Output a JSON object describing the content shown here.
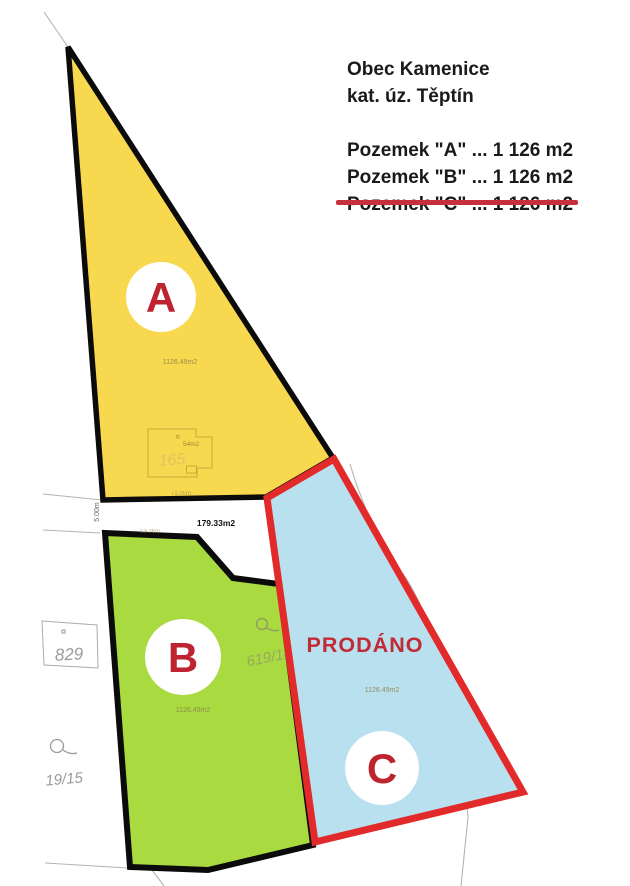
{
  "title": {
    "municipality": "Obec Kamenice",
    "cadastre": "kat. úz. Těptín"
  },
  "legend": {
    "rows": [
      {
        "text": "Pozemek \"A\" ... 1 126 m2",
        "struck": false
      },
      {
        "text": "Pozemek \"B\" ... 1 126 m2",
        "struck": false
      },
      {
        "text": "Pozemek \"C\" ... 1 126 m2",
        "struck": true
      }
    ]
  },
  "parcels": {
    "a": {
      "letter": "A",
      "area": "1126.49m2"
    },
    "b": {
      "letter": "B",
      "area": "1126.49m2"
    },
    "c": {
      "letter": "C",
      "area": "1126.49m2",
      "status": "PRODÁNO"
    }
  },
  "building": {
    "area": "54m2",
    "number": "165"
  },
  "dimensions": {
    "a_bottom_edge": "71.00m",
    "strip_width": "5.00m",
    "strip_area": "179.33m2",
    "b_top_edge": "13.36m"
  },
  "neighbor_plots": {
    "plot_829": "829",
    "plot_19_15": "19/15",
    "plot_619_14": "619/14"
  },
  "colors": {
    "parcel_a_fill": "#f8d84e",
    "parcel_b_fill": "#a9da3f",
    "parcel_c_fill": "#b8e0ee",
    "sold_border": "#e32a2a",
    "status_red": "#c22b35",
    "letter_red": "#be2430",
    "strike_red": "#c5303c",
    "outline_black": "#0b0b0b"
  }
}
